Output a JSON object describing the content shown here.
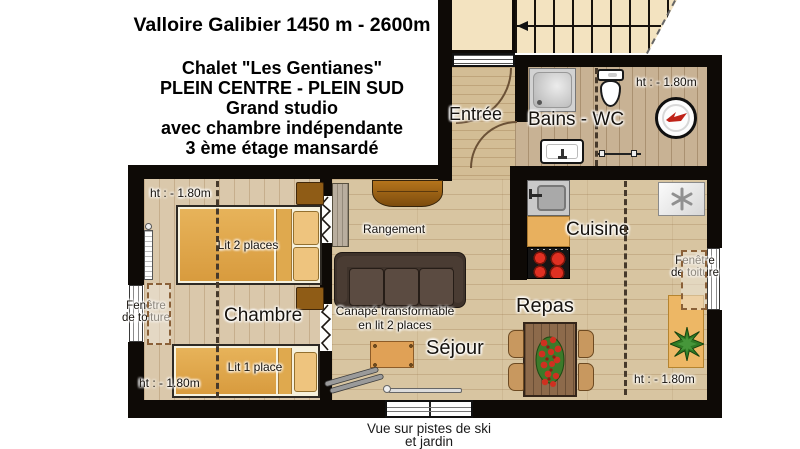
{
  "header": {
    "title": "Valloire Galibier 1450 m - 2600m",
    "subtitle_lines": [
      "Chalet \"Les Gentianes\"",
      "PLEIN CENTRE - PLEIN SUD",
      "Grand studio",
      "avec chambre indépendante",
      "3 ème étage  mansardé"
    ]
  },
  "rooms": {
    "entree": "Entrée",
    "bains_wc": "Bains - WC",
    "cuisine": "Cuisine",
    "repas": "Repas",
    "sejour": "Séjour",
    "chambre": "Chambre",
    "rangement": "Rangement"
  },
  "furniture": {
    "lit_2_places": "Lit 2 places",
    "lit_1_place": "Lit 1 place",
    "canape_line1": "Canapé transformable",
    "canape_line2": "en lit 2 places"
  },
  "annotations": {
    "height_limit": "ht : - 1.80m",
    "fenetre_line1": "Fenêtre",
    "fenetre_line2": "de toiture",
    "vue_line1": "Vue sur pistes de ski",
    "vue_line2": "et jardin"
  },
  "colors": {
    "wall": "#0e0a06",
    "wood_main": "#d8c5a1",
    "wood_bains": "#c8b294",
    "stairs_beige": "#f3e3c0",
    "bed_gold": "#e0a94e",
    "sofa_brown": "#43352c",
    "counter_orange": "#e8b05e",
    "burner_red": "#d42a1c",
    "plant_green": "#2f7a24"
  }
}
